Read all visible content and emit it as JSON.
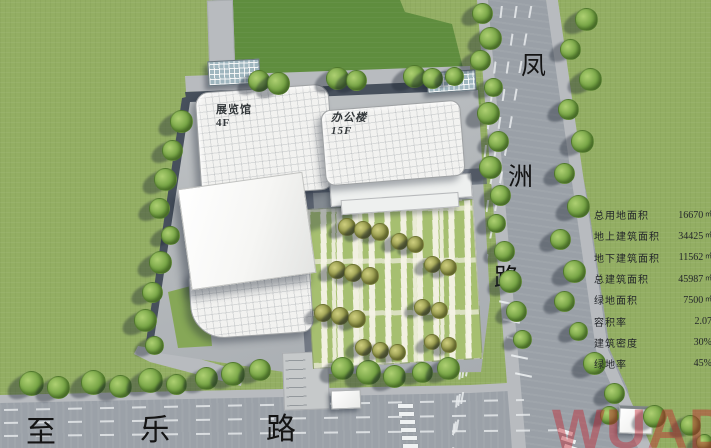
{
  "title": "建筑总平面图",
  "buildings": {
    "exhibition": {
      "name": "展览馆",
      "floors": "4F"
    },
    "office": {
      "name": "办公楼",
      "floors": "15F"
    }
  },
  "roads": {
    "vertical": {
      "name": "凤洲路",
      "chars": [
        "凤",
        "洲",
        "路"
      ]
    },
    "bottom": {
      "name": "至乐路",
      "chars": [
        "至",
        "乐",
        "路"
      ]
    }
  },
  "stats_table": {
    "rows": [
      {
        "label": "总用地面积",
        "value": "16670",
        "unit": "㎡"
      },
      {
        "label": "地上建筑面积",
        "value": "34425",
        "unit": "㎡"
      },
      {
        "label": "地下建筑面积",
        "value": "11562",
        "unit": "㎡"
      },
      {
        "label": "总建筑面积",
        "value": "45987",
        "unit": "㎡"
      },
      {
        "label": "绿地面积",
        "value": "7500",
        "unit": "㎡"
      },
      {
        "label": "容积率",
        "value": "2.07",
        "unit": ""
      },
      {
        "label": "建筑密度",
        "value": "30%",
        "unit": ""
      },
      {
        "label": "绿地率",
        "value": "45%",
        "unit": ""
      }
    ]
  },
  "watermark": {
    "text": "WUAD"
  },
  "colors": {
    "grass_light": "#93ae63",
    "grass_dark": "#5f8d3e",
    "road_gray": "#9aa0a7",
    "road_dark": "#47505c",
    "sidewalk": "#b8bbbf",
    "building_white": "#f2f2f0",
    "garden_green": "#a6bf70",
    "watermark_red": "#c3202a"
  },
  "scene": {
    "trees_green": [
      [
        258,
        80,
        20
      ],
      [
        277,
        82,
        21
      ],
      [
        336,
        77,
        21
      ],
      [
        355,
        79,
        19
      ],
      [
        413,
        75,
        21
      ],
      [
        431,
        77,
        19
      ],
      [
        453,
        75,
        17
      ],
      [
        180,
        120,
        21
      ],
      [
        171,
        149,
        19
      ],
      [
        164,
        178,
        21
      ],
      [
        158,
        207,
        19
      ],
      [
        169,
        234,
        17
      ],
      [
        159,
        261,
        21
      ],
      [
        151,
        291,
        19
      ],
      [
        144,
        319,
        21
      ],
      [
        153,
        344,
        17
      ],
      [
        30,
        382,
        23
      ],
      [
        57,
        386,
        21
      ],
      [
        92,
        381,
        23
      ],
      [
        119,
        385,
        21
      ],
      [
        149,
        379,
        23
      ],
      [
        175,
        383,
        19
      ],
      [
        205,
        377,
        21
      ],
      [
        232,
        373,
        22
      ],
      [
        259,
        369,
        20
      ],
      [
        341,
        367,
        21
      ],
      [
        367,
        371,
        23
      ],
      [
        393,
        375,
        21
      ],
      [
        421,
        371,
        19
      ],
      [
        447,
        367,
        21
      ],
      [
        481,
        12,
        19
      ],
      [
        489,
        37,
        21
      ],
      [
        479,
        59,
        19
      ],
      [
        492,
        86,
        17
      ],
      [
        487,
        112,
        21
      ],
      [
        497,
        140,
        19
      ],
      [
        489,
        166,
        21
      ],
      [
        499,
        194,
        19
      ],
      [
        495,
        222,
        17
      ],
      [
        503,
        250,
        19
      ],
      [
        509,
        280,
        21
      ],
      [
        515,
        310,
        19
      ],
      [
        521,
        338,
        17
      ],
      [
        585,
        18,
        21
      ],
      [
        569,
        48,
        19
      ],
      [
        589,
        78,
        21
      ],
      [
        567,
        108,
        19
      ],
      [
        581,
        140,
        21
      ],
      [
        563,
        172,
        19
      ],
      [
        577,
        205,
        21
      ],
      [
        559,
        238,
        19
      ],
      [
        573,
        270,
        21
      ],
      [
        563,
        300,
        19
      ],
      [
        577,
        330,
        17
      ],
      [
        593,
        362,
        21
      ],
      [
        613,
        392,
        19
      ],
      [
        608,
        414,
        17
      ],
      [
        653,
        415,
        21
      ],
      [
        689,
        424,
        19
      ],
      [
        703,
        441,
        15
      ]
    ],
    "trees_olive": [
      [
        346,
        226,
        16
      ],
      [
        362,
        229,
        16
      ],
      [
        379,
        231,
        16
      ],
      [
        398,
        240,
        15
      ],
      [
        414,
        243,
        15
      ],
      [
        336,
        269,
        16
      ],
      [
        352,
        272,
        16
      ],
      [
        369,
        275,
        16
      ],
      [
        431,
        263,
        15
      ],
      [
        447,
        266,
        15
      ],
      [
        322,
        312,
        16
      ],
      [
        339,
        315,
        16
      ],
      [
        356,
        318,
        16
      ],
      [
        421,
        306,
        15
      ],
      [
        438,
        309,
        15
      ],
      [
        362,
        346,
        15
      ],
      [
        379,
        349,
        15
      ],
      [
        396,
        351,
        15
      ],
      [
        431,
        341,
        14
      ],
      [
        448,
        344,
        14
      ]
    ]
  }
}
